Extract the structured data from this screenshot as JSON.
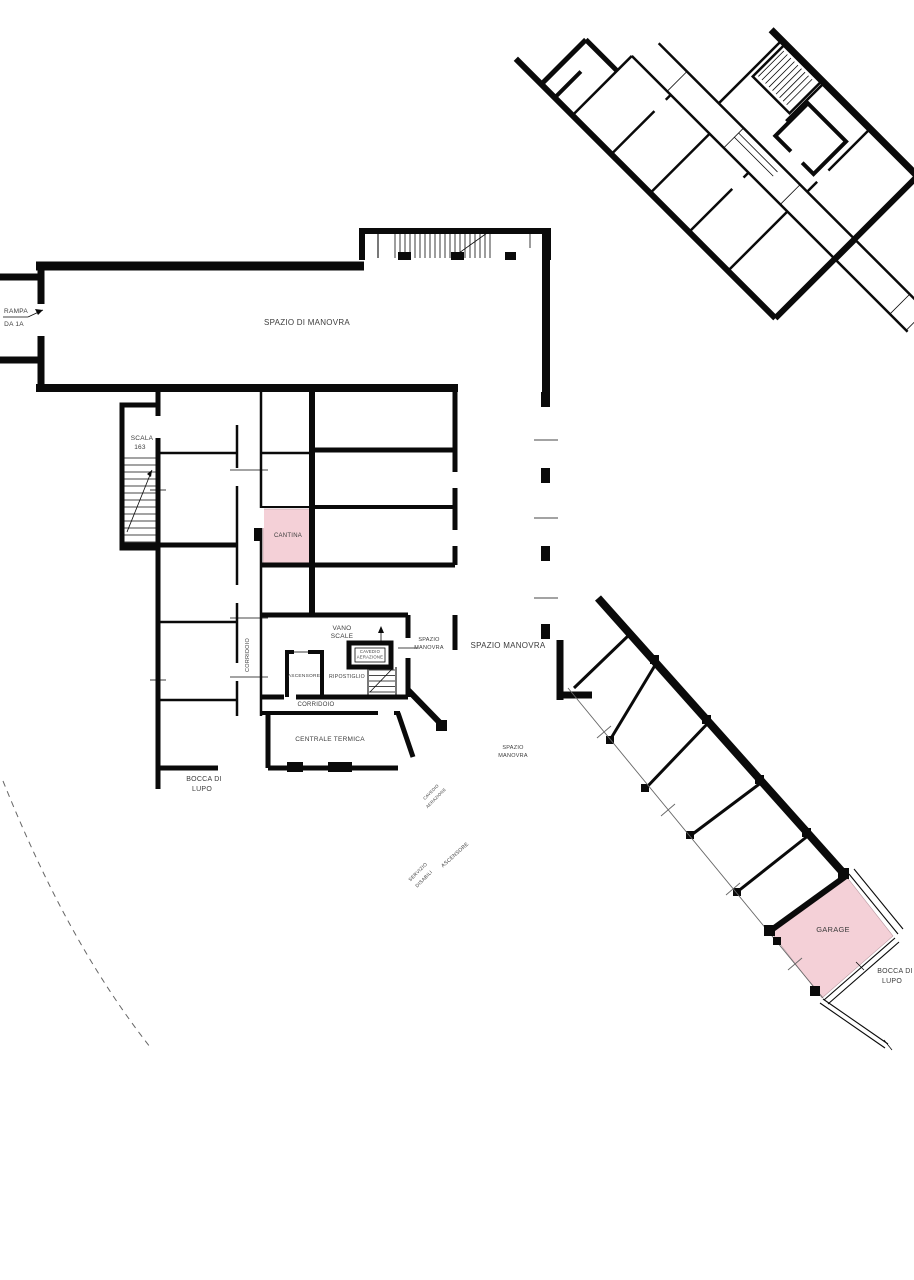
{
  "plan": {
    "title": "basement floor plan",
    "colors": {
      "wall": "#0a0a0a",
      "highlight": "#f4d0d7",
      "boundary": "#666666",
      "label": "#3c3c3c"
    },
    "labels": [
      {
        "id": "rampa-label-line1",
        "text": "RAMPA",
        "x": 16,
        "y": 313,
        "size": 6.5,
        "rotate": 0
      },
      {
        "id": "rampa-label-line2",
        "text": "DA 1A",
        "x": 14,
        "y": 326,
        "size": 6.5,
        "rotate": 0
      },
      {
        "id": "spazio-di-manovra-label",
        "text": "SPAZIO DI MANOVRA",
        "x": 307,
        "y": 325,
        "size": 8,
        "rotate": 0
      },
      {
        "id": "scala-label-line1",
        "text": "SCALA",
        "x": 142,
        "y": 440,
        "size": 6.5,
        "rotate": 0
      },
      {
        "id": "scala-label-line2",
        "text": "163",
        "x": 140,
        "y": 449,
        "size": 6.5,
        "rotate": 0
      },
      {
        "id": "cantina-label",
        "text": "CANTINA",
        "x": 288,
        "y": 537,
        "size": 6,
        "rotate": 0
      },
      {
        "id": "corridoio-vertical-label",
        "text": "CORRIDOIO",
        "x": 249,
        "y": 655,
        "size": 5.5,
        "rotate": -90
      },
      {
        "id": "vano-scale-label-line1",
        "text": "VANO",
        "x": 342,
        "y": 630,
        "size": 6.5,
        "rotate": 0
      },
      {
        "id": "vano-scale-label-line2",
        "text": "SCALE",
        "x": 342,
        "y": 638,
        "size": 6.5,
        "rotate": 0
      },
      {
        "id": "ascensore-label",
        "text": "ASCENSORE",
        "x": 304,
        "y": 677,
        "size": 4.8,
        "rotate": 0
      },
      {
        "id": "ripostiglio-label",
        "text": "RIPOSTIGLIO",
        "x": 347,
        "y": 678,
        "size": 5.2,
        "rotate": 0
      },
      {
        "id": "cavedio-label-line1",
        "text": "CAVEDIO",
        "x": 370,
        "y": 653,
        "size": 4.2,
        "rotate": 0
      },
      {
        "id": "cavedio-label-line2",
        "text": "AERAZIONE",
        "x": 370,
        "y": 658.5,
        "size": 4.2,
        "rotate": 0
      },
      {
        "id": "spazio-manovra-small-label-line1",
        "text": "SPAZIO",
        "x": 429,
        "y": 641,
        "size": 5.5,
        "rotate": 0
      },
      {
        "id": "spazio-manovra-small-label-line2",
        "text": "MANOVRA",
        "x": 429,
        "y": 649,
        "size": 5.5,
        "rotate": 0
      },
      {
        "id": "spazio-manovra-big-label",
        "text": "SPAZIO MANOVRA",
        "x": 508,
        "y": 648,
        "size": 8,
        "rotate": 0
      },
      {
        "id": "corridoio-horizontal-label",
        "text": "CORRIDOIO",
        "x": 316,
        "y": 706,
        "size": 6,
        "rotate": 0
      },
      {
        "id": "centrale-termica-label",
        "text": "CENTRALE TERMICA",
        "x": 330,
        "y": 741,
        "size": 6.5,
        "rotate": 0
      },
      {
        "id": "spazio-manovra-mid-label-line1",
        "text": "SPAZIO",
        "x": 513,
        "y": 749,
        "size": 5.5,
        "rotate": 0
      },
      {
        "id": "spazio-manovra-mid-label-line2",
        "text": "MANOVRA",
        "x": 513,
        "y": 757,
        "size": 5.5,
        "rotate": 0
      },
      {
        "id": "bocca-di-lupo-left-label-line1",
        "text": "BOCCA DI",
        "x": 204,
        "y": 781,
        "size": 7,
        "rotate": 0
      },
      {
        "id": "bocca-di-lupo-left-label-line2",
        "text": "LUPO",
        "x": 202,
        "y": 791,
        "size": 7,
        "rotate": 0
      },
      {
        "id": "cavedio-diag-label-line1",
        "text": "CAVEDIO",
        "x": 432,
        "y": 793,
        "size": 4.2,
        "rotate": -45
      },
      {
        "id": "cavedio-diag-label-line2",
        "text": "AERAZIONE",
        "x": 437,
        "y": 799,
        "size": 4.2,
        "rotate": -45
      },
      {
        "id": "ascensore-diag-label",
        "text": "ASCENSORE",
        "x": 456,
        "y": 856,
        "size": 5.2,
        "rotate": -42
      },
      {
        "id": "servizio-diag-label-line1",
        "text": "SERVIZIO",
        "x": 419,
        "y": 873,
        "size": 4.8,
        "rotate": -45
      },
      {
        "id": "servizio-diag-label-line2",
        "text": "DISABILI",
        "x": 425,
        "y": 880,
        "size": 4.8,
        "rotate": -45
      },
      {
        "id": "garage-label",
        "text": "GARAGE",
        "x": 833,
        "y": 932,
        "size": 7.5,
        "rotate": 0
      },
      {
        "id": "bocca-di-lupo-right-label-line1",
        "text": "BOCCA DI",
        "x": 895,
        "y": 973,
        "size": 7,
        "rotate": 0
      },
      {
        "id": "bocca-di-lupo-right-label-line2",
        "text": "LUPO",
        "x": 892,
        "y": 983,
        "size": 7,
        "rotate": 0
      }
    ]
  }
}
